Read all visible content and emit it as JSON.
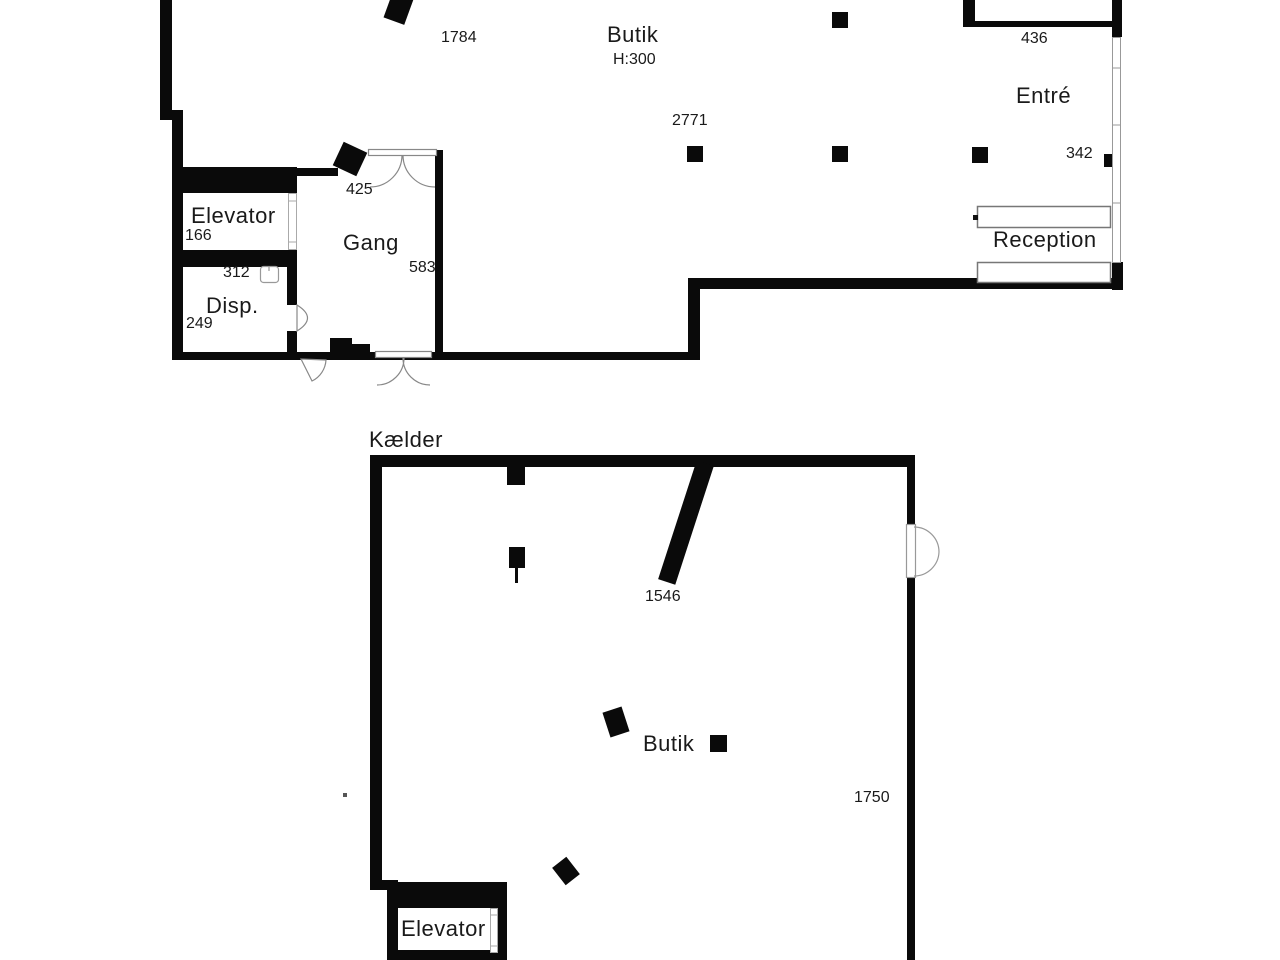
{
  "upper_plan": {
    "rooms": {
      "butik_label": "Butik",
      "butik_height": "H:300",
      "gang_label": "Gang",
      "elevator_label": "Elevator",
      "disp_label": "Disp.",
      "entre_label": "Entré",
      "reception_label": "Reception"
    },
    "dimensions": {
      "d1784": "1784",
      "d2771": "2771",
      "d436": "436",
      "d342": "342",
      "d425": "425",
      "d583": "583",
      "d166": "166",
      "d312": "312",
      "d249": "249"
    }
  },
  "basement_plan": {
    "title": "Kælder",
    "rooms": {
      "butik_label": "Butik",
      "elevator_label": "Elevator"
    },
    "dimensions": {
      "d1546": "1546",
      "d1750": "1750"
    }
  },
  "colors": {
    "wall": "#0a0a0a",
    "text": "#1a1a1a",
    "door_stroke": "#888888",
    "background": "#ffffff"
  }
}
